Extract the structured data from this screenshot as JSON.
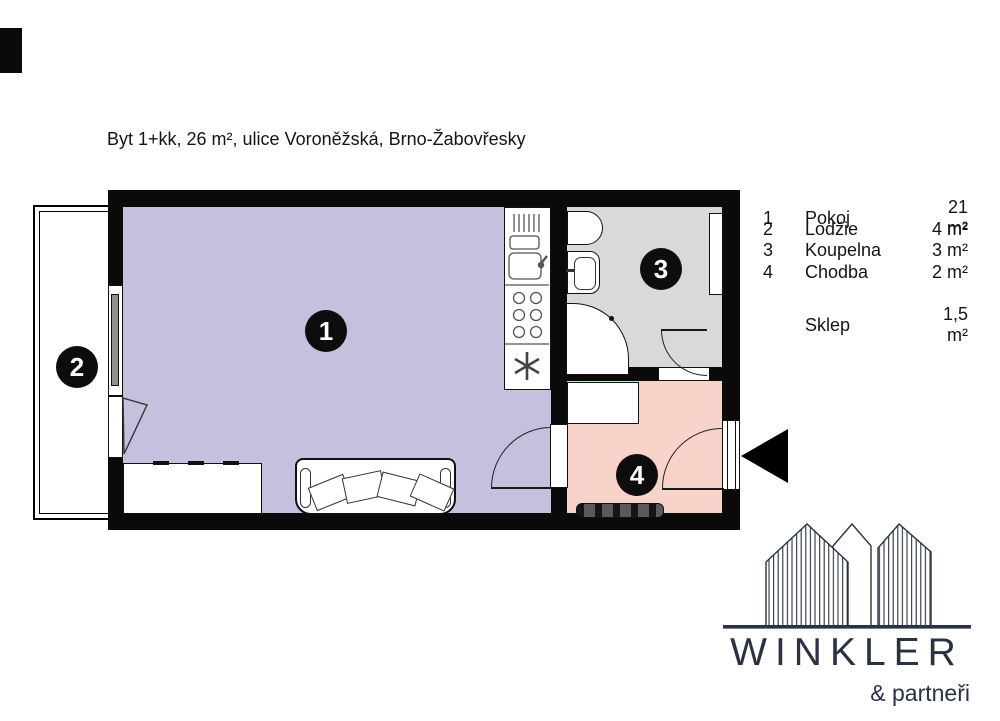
{
  "title": "Byt 1+kk, 26 m², ulice Voroněžská, Brno-Žabovřesky",
  "legend": {
    "rows": [
      {
        "num": "1",
        "label": "Pokoj",
        "area": "21 m²"
      },
      {
        "num": "2",
        "label": "Lodžie",
        "area": "4 m²"
      },
      {
        "num": "3",
        "label": "Koupelna",
        "area": "3 m²"
      },
      {
        "num": "4",
        "label": "Chodba",
        "area": "2 m²"
      }
    ],
    "extra": {
      "label": "Sklep",
      "area": "1,5 m²"
    }
  },
  "plan": {
    "wall_color": "#0a0a0a",
    "colors": {
      "pokoj": "#c6c0df",
      "lodzie": "#ffffff",
      "koupelna": "#d9d9dc",
      "chodba": "#f8d3ca"
    },
    "icons": {
      "entrance_arrow": "left-triangle",
      "fridge_star": "six-spoke-star"
    }
  },
  "logo": {
    "name": "WINKLER",
    "tagline": "& partneři",
    "color": "#2a3143"
  }
}
